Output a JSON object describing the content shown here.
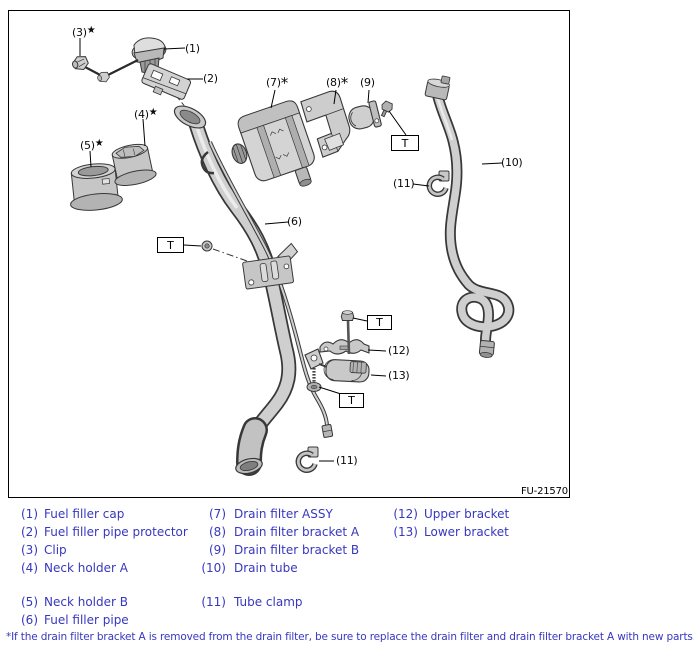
{
  "diagram": {
    "figure_code": "FU-21570",
    "torque_symbol": "T",
    "callouts": {
      "c1": {
        "label": "(1)",
        "suffix": ""
      },
      "c2": {
        "label": "(2)",
        "suffix": ""
      },
      "c3": {
        "label": "(3)",
        "suffix": "★"
      },
      "c4": {
        "label": "(4)",
        "suffix": "★"
      },
      "c5": {
        "label": "(5)",
        "suffix": "★"
      },
      "c6": {
        "label": "(6)",
        "suffix": ""
      },
      "c7": {
        "label": "(7)",
        "suffix": "*"
      },
      "c8": {
        "label": "(8)",
        "suffix": "*"
      },
      "c9": {
        "label": "(9)",
        "suffix": ""
      },
      "c10": {
        "label": "(10)",
        "suffix": ""
      },
      "c11a": {
        "label": "(11)",
        "suffix": ""
      },
      "c11b": {
        "label": "(11)",
        "suffix": ""
      },
      "c12": {
        "label": "(12)",
        "suffix": ""
      },
      "c13": {
        "label": "(13)",
        "suffix": ""
      }
    }
  },
  "legend": {
    "items": [
      {
        "num": "(1)",
        "label": "Fuel filler cap"
      },
      {
        "num": "(2)",
        "label": "Fuel filler pipe protector"
      },
      {
        "num": "(3)",
        "label": "Clip"
      },
      {
        "num": "(4)",
        "label": "Neck holder A"
      },
      {
        "num": "(5)",
        "label": "Neck holder B"
      },
      {
        "num": "(6)",
        "label": "Fuel filler pipe"
      },
      {
        "num": "(7)",
        "label": "Drain filter ASSY"
      },
      {
        "num": "(8)",
        "label": "Drain filter bracket A"
      },
      {
        "num": "(9)",
        "label": "Drain filter bracket B"
      },
      {
        "num": "(10)",
        "label": "Drain tube"
      },
      {
        "num": "(11)",
        "label": "Tube clamp"
      },
      {
        "num": "(12)",
        "label": "Upper bracket"
      },
      {
        "num": "(13)",
        "label": "Lower bracket"
      }
    ]
  },
  "footnote": "*If the drain filter bracket A is removed from the drain filter, be sure to replace the drain filter and drain filter bracket A with new parts.",
  "colors": {
    "legend_text": "#3737c0",
    "line": "#000000",
    "part_outline": "#383838",
    "part_fill": "#d4d4d4"
  }
}
